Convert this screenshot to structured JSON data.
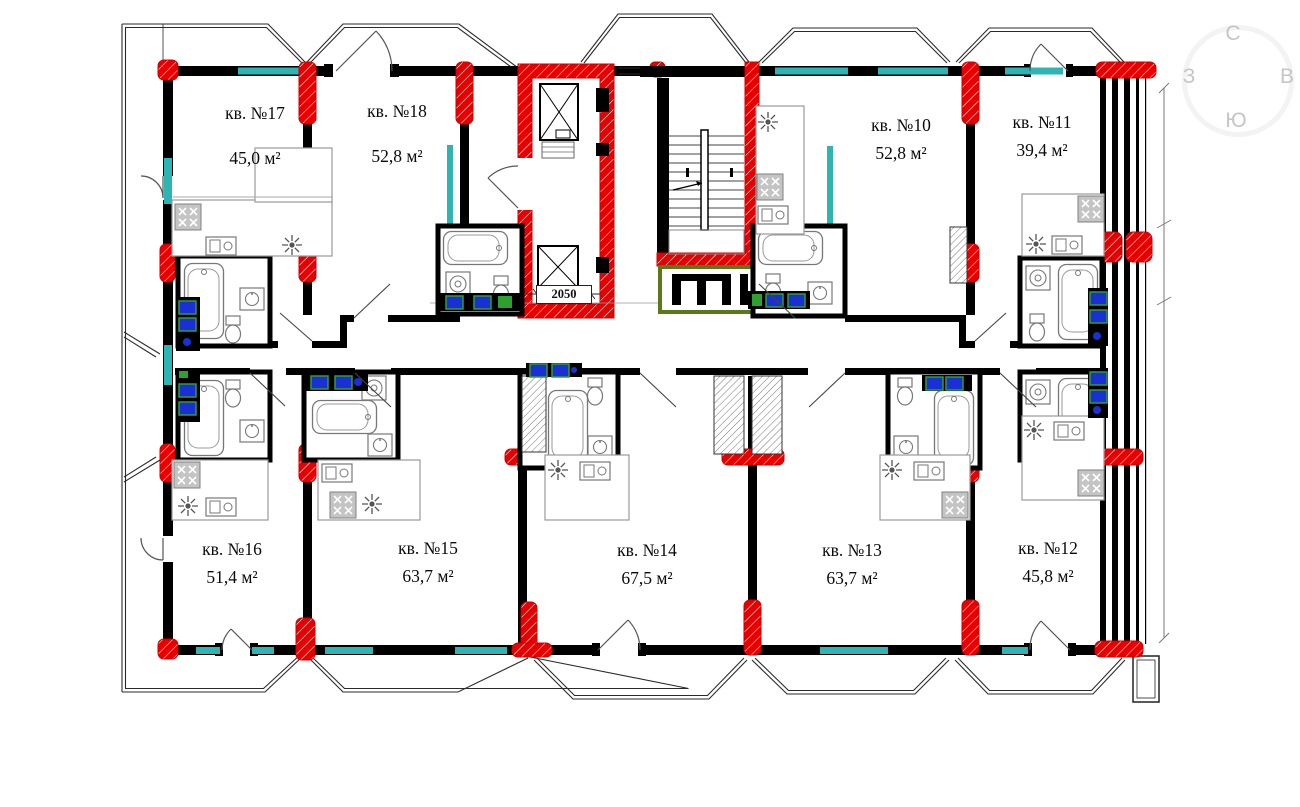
{
  "plan": {
    "compass": {
      "north": "С",
      "east": "В",
      "south": "Ю",
      "west": "З"
    },
    "elevator_dimension": "2050",
    "apartments": [
      {
        "number": "17",
        "label": "кв. №17",
        "area": "45,0 м²"
      },
      {
        "number": "18",
        "label": "кв. №18",
        "area": "52,8 м²"
      },
      {
        "number": "10",
        "label": "кв. №10",
        "area": "52,8 м²"
      },
      {
        "number": "11",
        "label": "кв. №11",
        "area": "39,4 м²"
      },
      {
        "number": "16",
        "label": "кв. №16",
        "area": "51,4 м²"
      },
      {
        "number": "15",
        "label": "кв. №15",
        "area": "63,7 м²"
      },
      {
        "number": "14",
        "label": "кв. №14",
        "area": "67,5 м²"
      },
      {
        "number": "13",
        "label": "кв. №13",
        "area": "63,7 м²"
      },
      {
        "number": "12",
        "label": "кв. №12",
        "area": "45,8 м²"
      }
    ],
    "colors": {
      "walls": "#000000",
      "windows": "#2fb4b4",
      "columns_highlight": "#e80000",
      "vent_blocks": "#1b2fd6",
      "vent_trim": "#2ea02e",
      "lobby_trim": "#5a7a1a",
      "compass_text": "#c5c5c5"
    }
  }
}
